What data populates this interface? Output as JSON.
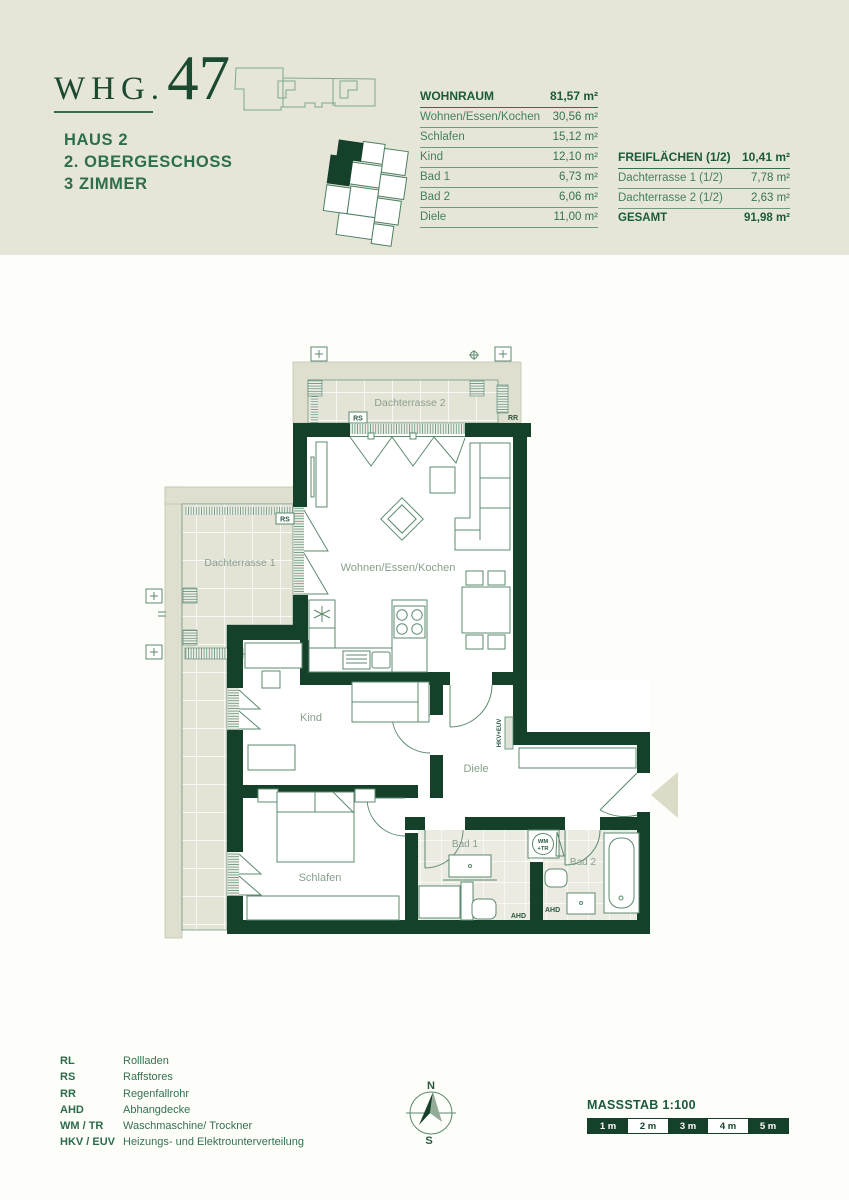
{
  "colors": {
    "dark_green": "#15402a",
    "accent_green": "#2d6e4d",
    "band_beige": "#e6e6d8"
  },
  "header": {
    "brand_prefix": "WHG.",
    "unit_number": "47",
    "house": "HAUS 2",
    "floor": "2. OBERGESCHOSS",
    "rooms": "3 ZIMMER"
  },
  "area_tables": {
    "wohnraum": {
      "title": "WOHNRAUM",
      "total": "81,57 m²",
      "rows": [
        {
          "label": "Wohnen/Essen/Kochen",
          "value": "30,56 m²"
        },
        {
          "label": "Schlafen",
          "value": "15,12 m²"
        },
        {
          "label": "Kind",
          "value": "12,10 m²"
        },
        {
          "label": "Bad 1",
          "value": "6,73 m²"
        },
        {
          "label": "Bad 2",
          "value": "6,06 m²"
        },
        {
          "label": "Diele",
          "value": "11,00 m²"
        }
      ]
    },
    "freiflaechen": {
      "title": "FREIFLÄCHEN (1/2)",
      "total": "10,41 m²",
      "rows": [
        {
          "label": "Dachterrasse 1  (1/2)",
          "value": "7,78 m²"
        },
        {
          "label": "Dachterrasse 2  (1/2)",
          "value": "2,63 m²"
        }
      ],
      "total_label": "GESAMT",
      "total_value": "91,98 m²"
    }
  },
  "floorplan": {
    "rooms": {
      "dachterrasse2": "Dachterrasse 2",
      "dachterrasse1": "Dachterrasse 1",
      "wohnen": "Wohnen/Essen/Kochen",
      "kind": "Kind",
      "diele": "Diele",
      "schlafen": "Schlafen",
      "bad1": "Bad 1",
      "bad2": "Bad 2"
    },
    "annotations": {
      "rs": "RS",
      "rr": "RR",
      "ahd": "AHD",
      "hkv": "HKV+EUV",
      "wm": "WM",
      "tr": "+TR"
    }
  },
  "legend": {
    "items": [
      {
        "abbr": "RL",
        "desc": "Rollladen"
      },
      {
        "abbr": "RS",
        "desc": "Raffstores"
      },
      {
        "abbr": "RR",
        "desc": "Regenfallrohr"
      },
      {
        "abbr": "AHD",
        "desc": "Abhangdecke"
      },
      {
        "abbr": "WM / TR",
        "desc": "Waschmaschine/ Trockner"
      },
      {
        "abbr": "HKV / EUV",
        "desc": "Heizungs- und Elektrounterverteilung"
      }
    ]
  },
  "compass": {
    "north": "N",
    "south": "S"
  },
  "scale": {
    "title": "MASSSTAB 1:100",
    "segments": [
      "1 m",
      "2 m",
      "3 m",
      "4 m",
      "5 m"
    ]
  }
}
